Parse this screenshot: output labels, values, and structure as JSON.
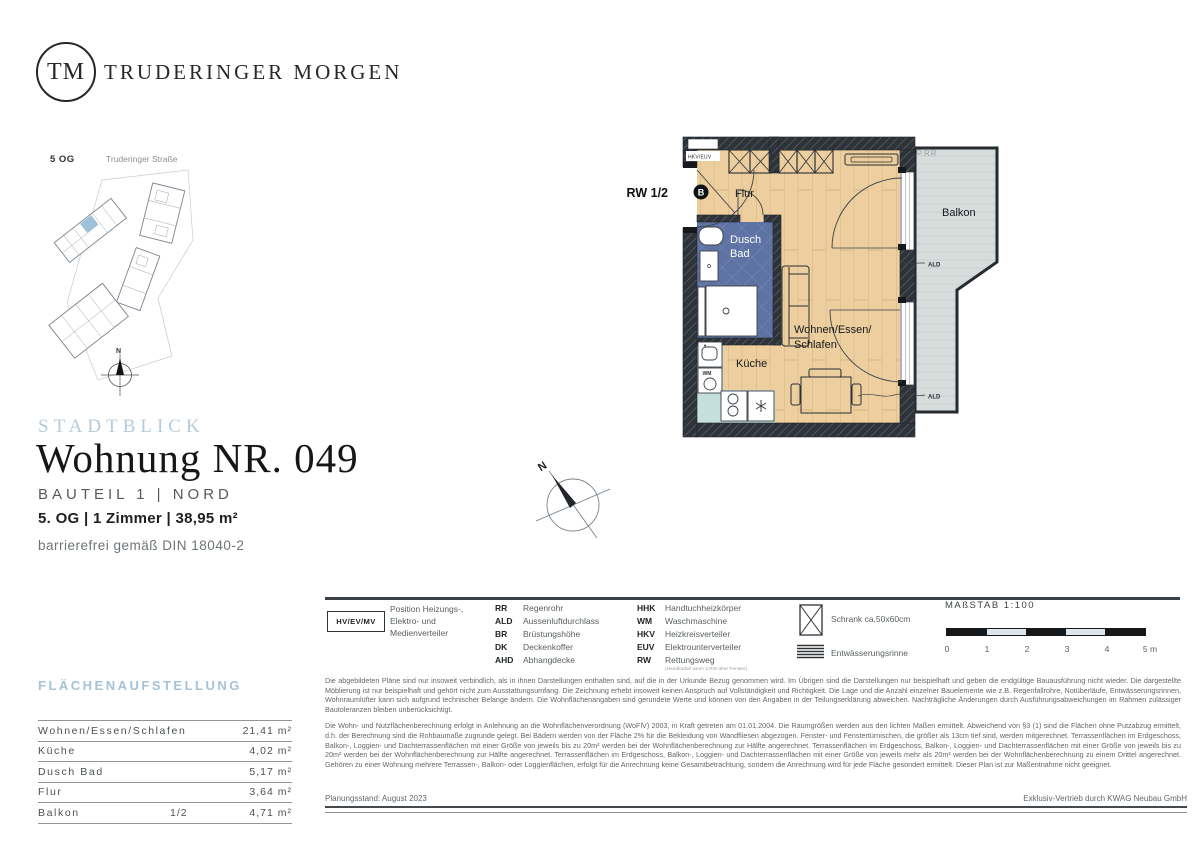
{
  "brand": {
    "initials": "TM",
    "name": "TRUDERINGER MORGEN"
  },
  "site_plan": {
    "floor": "5 OG",
    "street": "Truderinger Straße",
    "north": "N"
  },
  "title_block": {
    "project": "STADTBLICK",
    "title": "Wohnung NR. 049",
    "part": "BAUTEIL 1 | NORD",
    "specs": "5. OG | 1 Zimmer | 38,95 m²",
    "note": "barrierefrei gemäß DIN 18040-2"
  },
  "plan": {
    "north": "N",
    "labels": {
      "rw": "RW 1/2",
      "entrance_marker": "B",
      "hkv": "HKV/EUV",
      "rr": "RR",
      "flur": "Flur",
      "dusch": "Dusch",
      "bad": "Bad",
      "wohnen1": "Wohnen/Essen/",
      "wohnen2": "Schlafen",
      "kueche": "Küche",
      "balkon": "Balkon",
      "wm": "WM",
      "ald": "ALD"
    }
  },
  "legend": {
    "hv_box": "HV/EV/MV",
    "hv_desc": "Position Heizungs-, Elektro- und Medienverteiler",
    "col1": [
      {
        "abbr": "RR",
        "term": "Regenrohr"
      },
      {
        "abbr": "ALD",
        "term": "Aussenluftdurchlass"
      },
      {
        "abbr": "BR",
        "term": "Brüstungshöhe"
      },
      {
        "abbr": "DK",
        "term": "Deckenkoffer"
      },
      {
        "abbr": "AHD",
        "term": "Abhangdecke"
      }
    ],
    "col2": [
      {
        "abbr": "HHK",
        "term": "Handtuchheizkörper"
      },
      {
        "abbr": "WM",
        "term": "Waschmaschine"
      },
      {
        "abbr": "HKV",
        "term": "Heizkreisverteiler"
      },
      {
        "abbr": "EUV",
        "term": "Elektrounterverteiler"
      },
      {
        "abbr": "RW",
        "term": "Rettungsweg"
      }
    ],
    "rw_note": "(Handkurbel wenn 2.RW über Fenster)",
    "symbols": {
      "schrank": "Schrank ca.50x60cm",
      "rinne": "Entwässerungsrinne"
    },
    "scale": {
      "label": "MAßSTAB 1:100",
      "ticks": [
        "0",
        "1",
        "2",
        "3",
        "4",
        "5 m"
      ]
    }
  },
  "area_table": {
    "heading": "FLÄCHENAUFSTELLUNG",
    "rows": [
      {
        "label": "Wohnen/Essen/Schlafen",
        "share": "",
        "area": "21,41 m²"
      },
      {
        "label": "Küche",
        "share": "",
        "area": "4,02 m²"
      },
      {
        "label": "Dusch Bad",
        "share": "",
        "area": "5,17 m²"
      },
      {
        "label": "Flur",
        "share": "",
        "area": "3,64 m²"
      },
      {
        "label": "Balkon",
        "share": "1/2",
        "area": "4,71 m²"
      }
    ]
  },
  "disclaimer": {
    "p1": "Die abgebildeten Pläne sind nur insoweit verbindlich, als in ihnen Darstellungen enthalten sind, auf die in der Urkunde Bezug genommen wird. Im Übrigen sind die Darstellungen nur beispielhaft und geben die endgültige Bauausführung nicht wieder. Die dargestellte Möblierung ist nur beispielhaft und gehört nicht zum Ausstattungsumfang. Die Zeichnung erhebt insoweit keinen Anspruch auf Vollständigkeit und Richtigkeit. Die Lage und die Anzahl einzelner Bauelemente wie z.B. Regenfallrohre, Notüberläufe, Entwässerungsrinnen, Wohnraumlüfter kann sich aufgrund technischer Belange ändern. Die Wohnflächenangaben sind gerundete Werte und können von den Angaben in der Teilungserklärung abweichen. Nachträgliche Änderungen durch Ausführungsabweichungen im Rahmen zulässiger Bautoleranzen bleiben unberücksichtigt.",
    "p2": "Die Wohn- und Nutzflächenberechnung erfolgt in Anlehnung an die Wohnflächenverordnung (WoFlV) 2003, in Kraft getreten am 01.01.2004. Die Raumgrößen werden aus den lichten Maßen ermittelt. Abweichend von §3 (1) sind die Flächen ohne Putzabzug ermittelt, d.h. der Berechnung sind die Rohbaumaße zugrunde gelegt. Bei Bädern werden von der Fläche 2% für die Bekleidung von Wandfliesen abgezogen. Fenster- und Fenstertürnischen, die größer als 13cm tief sind, werden mitgerechnet. Terrassenflächen im Erdgeschoss, Balkon-, Loggien- und Dachterrassenflächen mit einer Größe von jeweils bis zu 20m² werden bei der Wohnflächenberechnung zur Hälfte angerechnet. Terrassenflächen im Erdgeschoss, Balkon-, Loggien- und Dachterrassenflächen mit einer Größe von jeweils bis zu 20m² werden bei der Wohnflächenberechnung zur Hälfte angerechnet. Terrassenflächen im Erdgeschoss, Balkon-, Loggien- und Dachterrassenflächen mit einer Größe von jeweils mehr als 20m² werden bei der Wohnflächenberechnung zu einem Drittel angerechnet. Gehören zu einer Wohnung mehrere Terrassen-, Balkon- oder Loggienflächen, erfolgt für die Anrechnung keine Gesamtbetrachtung, sondern die Anrechnung wird für jede Fläche gesondert ermittelt. Dieser Plan ist zur Maßentnahme nicht geeignet."
  },
  "footer": {
    "left": "Planungsstand: August 2023",
    "right": "Exklusiv-Vertrieb durch KWAG Neubau GmbH"
  },
  "colors": {
    "accent_blue": "#b5cbdc",
    "wall": "#2d3339",
    "wood": "#ecce9f",
    "bath_tile": "#5e73a4",
    "kitchen": "#c4dfdc",
    "balcony": "#d6dddc",
    "highlight_unit": "#9dc1da"
  }
}
